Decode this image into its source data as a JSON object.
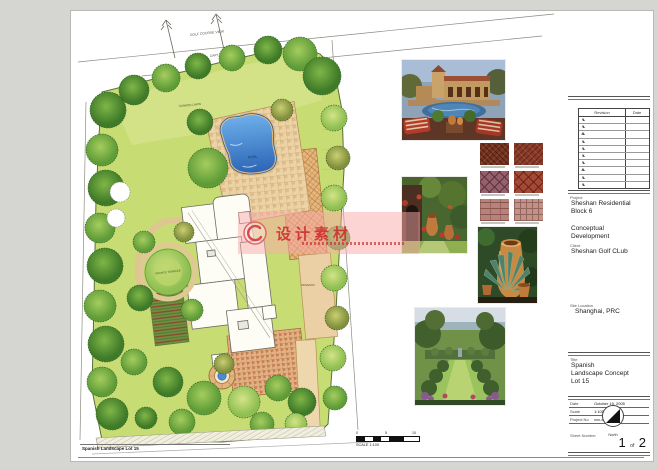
{
  "plan": {
    "labels": {
      "golf_view": "GOLF COURSE VIEW",
      "cart_path": "CART PATH",
      "sunken_lawn": "SUNKEN LAWN",
      "pool": "POOL",
      "private_terrace": "PRIVATE TERRACE",
      "driveway": "DRIVEWAY"
    },
    "footer": "Spanish Landscape Lot 15",
    "scale_caption": "SCALE 1:100",
    "scale_ticks": {
      "t0": "0",
      "t1": "5",
      "t2": "10"
    },
    "colors": {
      "lawn": "#c8dc74",
      "pool_blue": "#3f7fd0",
      "terracotta": "#e2b184",
      "tree_dark": "#4e8a2f"
    }
  },
  "watermark": {
    "text": "设计素材",
    "color": "#cd2828"
  },
  "titleblock": {
    "revision_header": {
      "revision": "Revision",
      "date": "Date"
    },
    "revision_rows": 10,
    "project_label": "Project",
    "project_line1": "Sheshan Residential",
    "project_line2": "Block 6",
    "phase_line1": "Conceptual",
    "phase_line2": "Development",
    "client_label": "Client",
    "client": "Sheshan Golf CLub",
    "site_label": "Site Location",
    "site": "Shanghai, PRC",
    "title_label": "Title",
    "title_line1": "Spanish",
    "title_line2": "Landscape Concept",
    "title_line3": "Lot 15",
    "date_label": "Date",
    "date_value": "October 19, 2005",
    "scale_label": "Scale",
    "scale_value": "1:100",
    "projno_label": "Project No",
    "projno_value": "xxx-xxx",
    "north_label": "North",
    "sheet_label": "Sheet Number",
    "sheet_no": "1",
    "sheet_of": "of",
    "sheet_total": "2"
  }
}
